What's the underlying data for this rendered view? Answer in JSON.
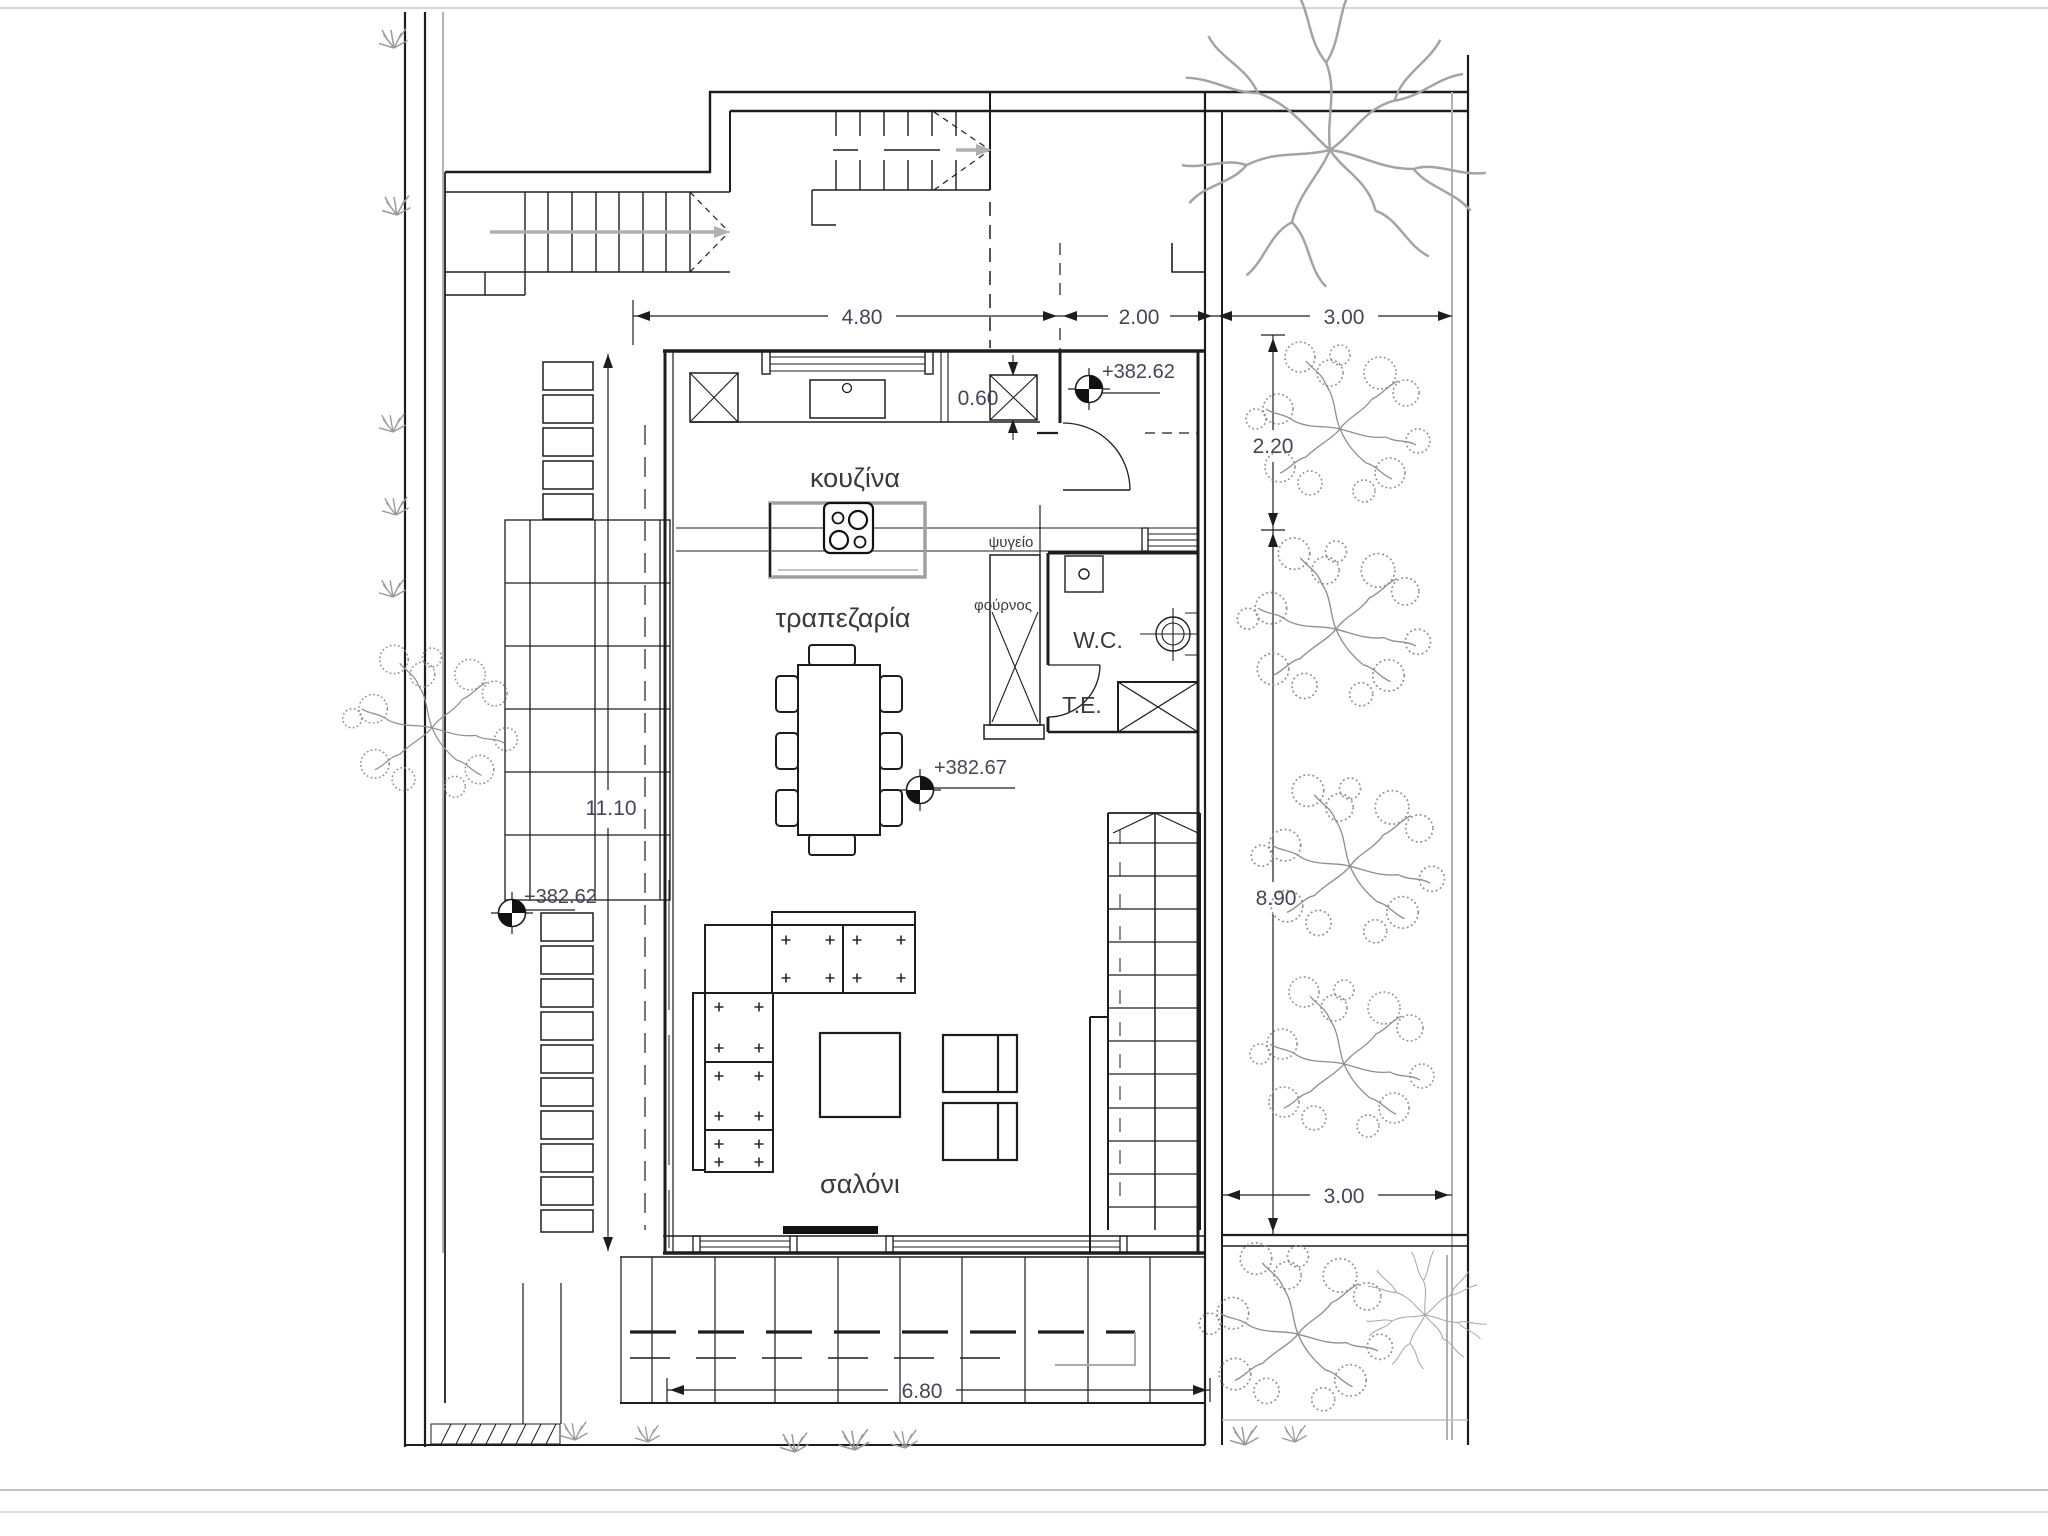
{
  "title": "ground-floor-plan",
  "colors": {
    "line": "#1d1d1d",
    "construction_gray": "#9b9b9b",
    "dimension_text": "#454559",
    "label_text": "#3a3a3a"
  },
  "rooms": {
    "kitchen": "κουζίνα",
    "dining": "τραπεζαρία",
    "living": "σαλόνι",
    "wc": "W.C.",
    "te": "T.E.",
    "fridge": "ψυγείο",
    "oven": "φούρνος"
  },
  "dimensions": {
    "top_left": "4.80",
    "top_middle": "2.00",
    "top_right": "3.00",
    "counter_niche": "0.60",
    "right_upper": "2.20",
    "right_lower": "8.90",
    "left_height": "11.10",
    "terrace_width": "6.80",
    "bottom_right": "3.00"
  },
  "levels": {
    "entry": "+382.62",
    "interior": "+382.67",
    "terrace": "+382.62"
  }
}
